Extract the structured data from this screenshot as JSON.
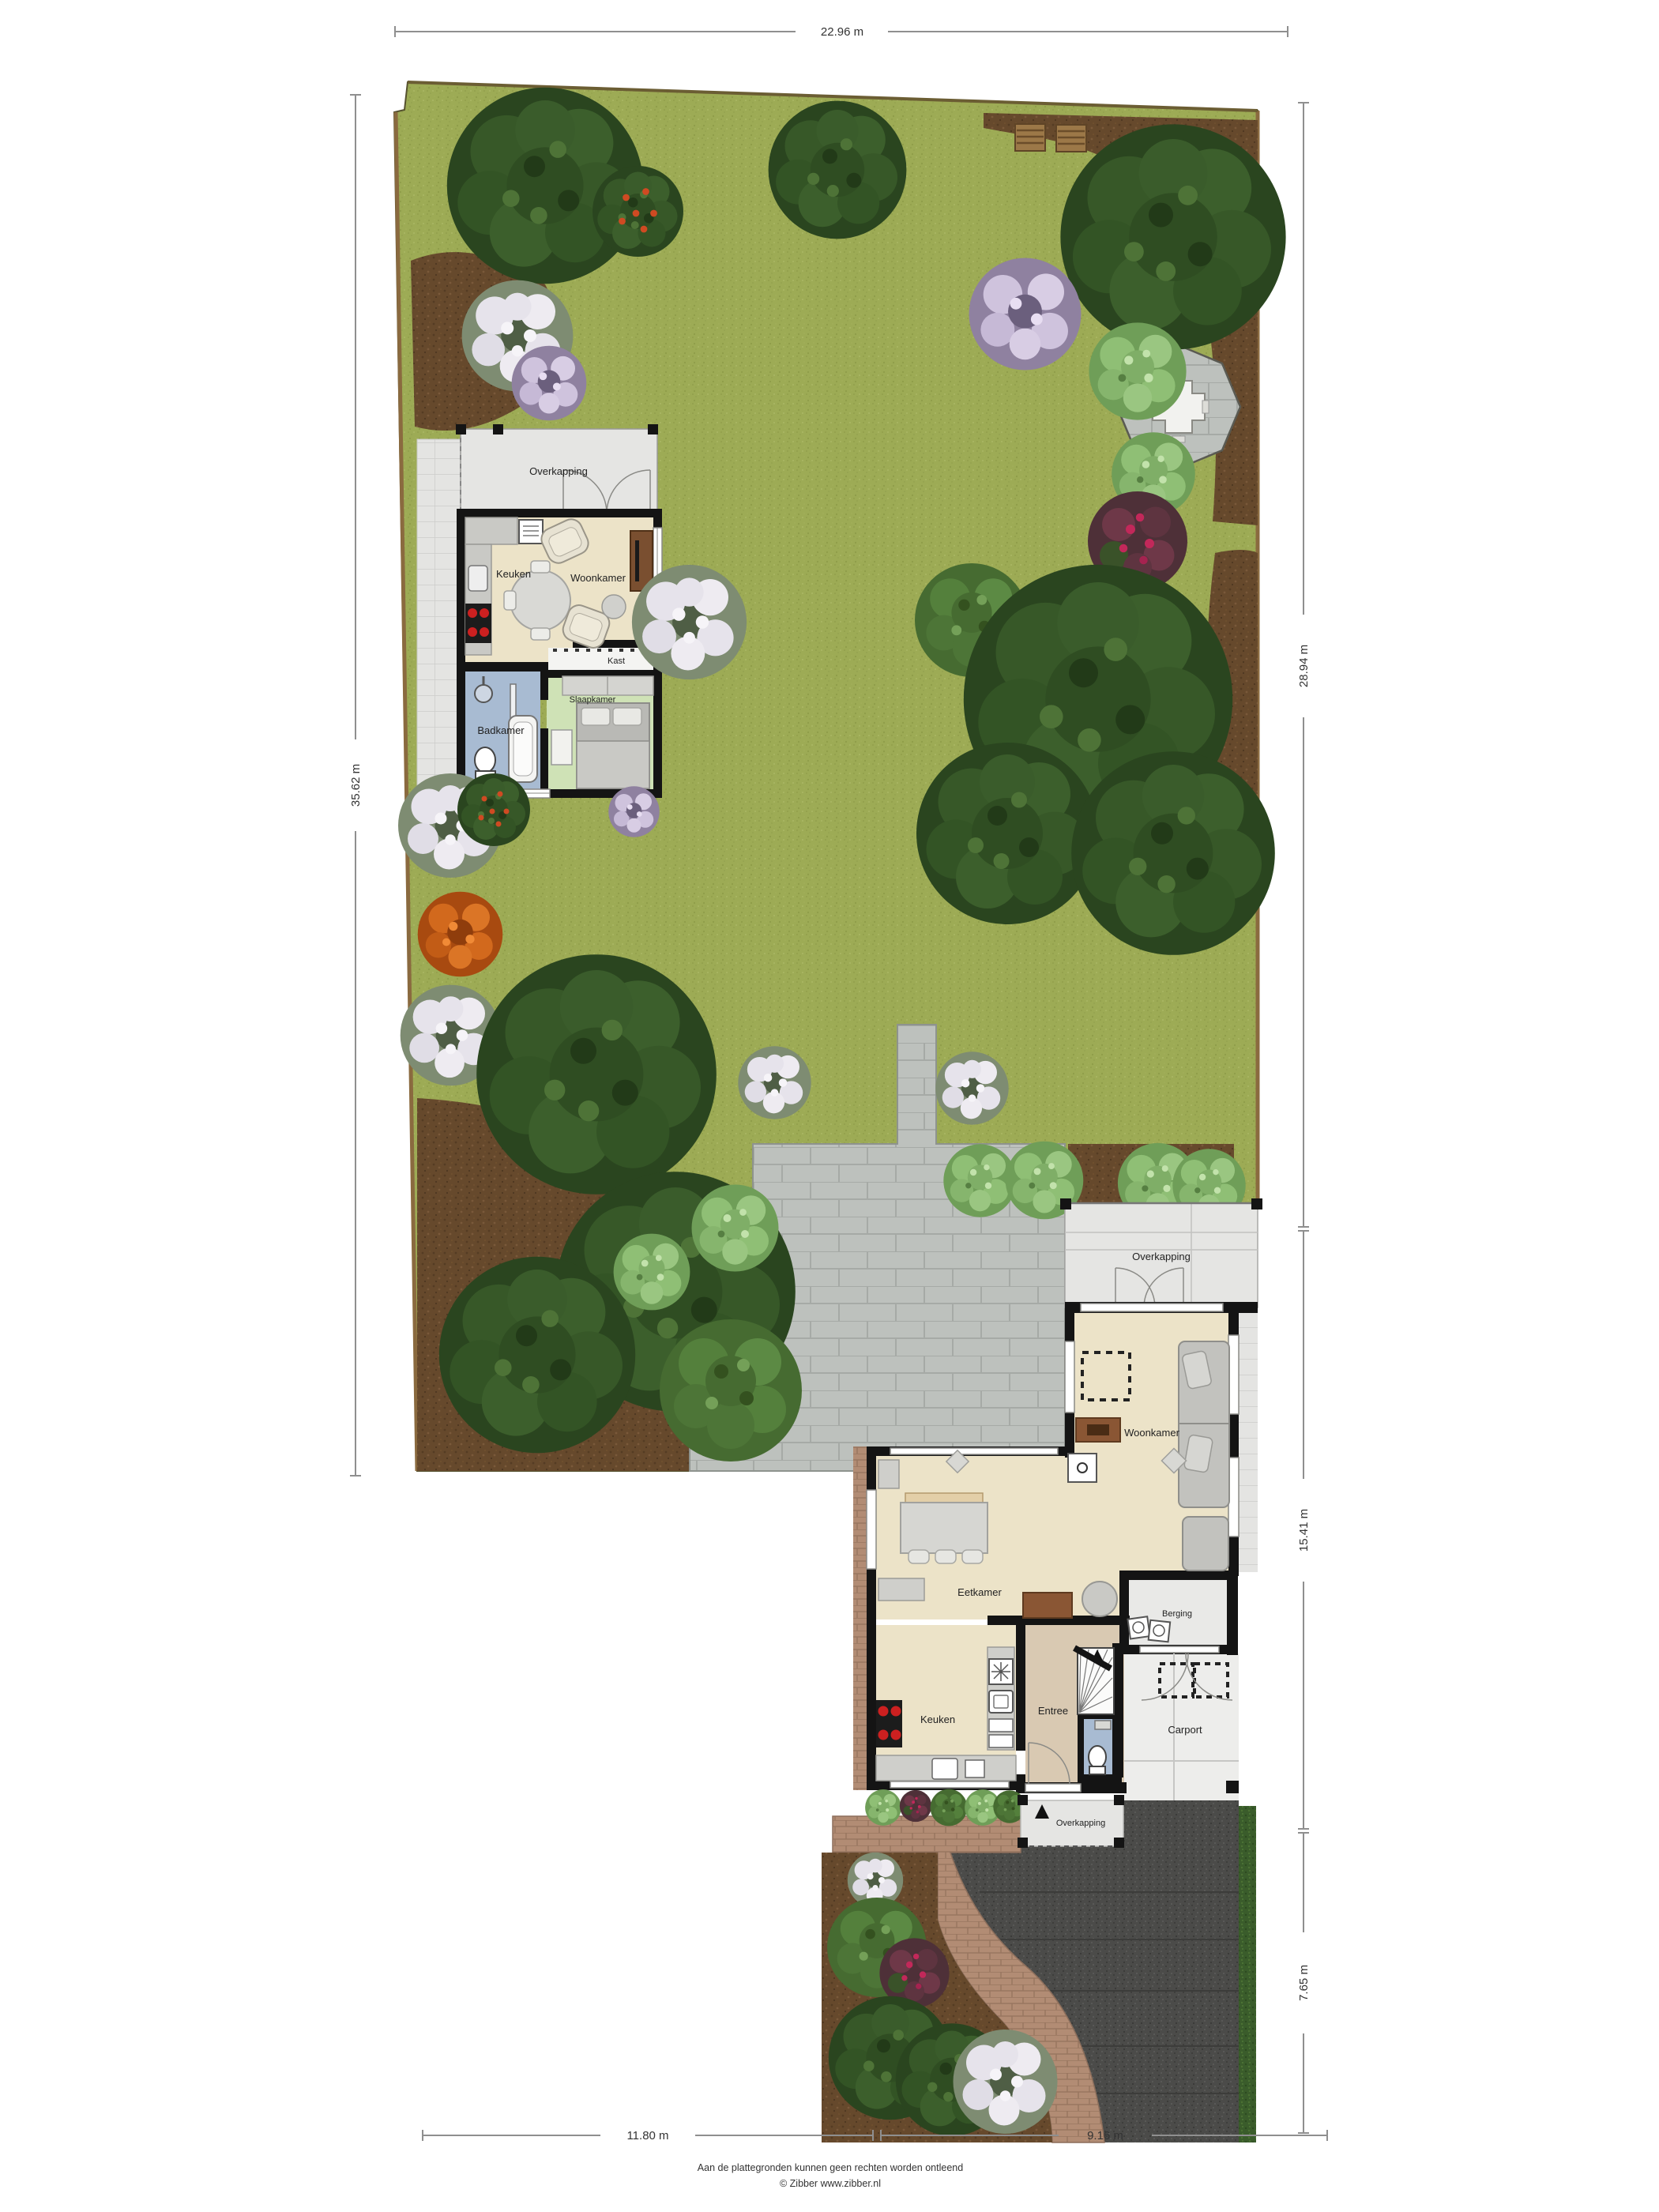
{
  "dimensions": {
    "top": "22.96 m",
    "left": "35.62 m",
    "right_upper": "28.94 m",
    "right_middle": "15.41 m",
    "right_lower": "7.65 m",
    "bottom_left": "11.80 m",
    "bottom_right": "9.16 m"
  },
  "annex": {
    "overkapping": "Overkapping",
    "keuken": "Keuken",
    "woonkamer": "Woonkamer",
    "kast": "Kast",
    "badkamer": "Badkamer",
    "slaapkamer": "Slaapkamer"
  },
  "house": {
    "overkapping": "Overkapping",
    "woonkamer": "Woonkamer",
    "eetkamer": "Eetkamer",
    "keuken": "Keuken",
    "entree": "Entree",
    "berging": "Berging",
    "carport": "Carport",
    "overkapping_front": "Overkapping"
  },
  "footer": {
    "line1": "Aan de plattegronden kunnen geen rechten worden ontleend",
    "line2": "© Zibber www.zibber.nl"
  },
  "colors": {
    "lawn": "#9dab55",
    "soil": "#66492c",
    "tree_dark": "#2e4a22",
    "bush_light": "#8fbf75",
    "paving": "#bdc1bd",
    "asphalt": "#4b4b49",
    "brick_path": "#b28c74",
    "hedge": "#3a5c2b",
    "wall": "#141414",
    "floor_living": "#ece3c8",
    "floor_bathroom": "#a8bbd2",
    "floor_bedroom": "#cfe2b6",
    "floor_entree": "#d9c9b2",
    "canopy": "#e5e5e3",
    "floor_utility": "#e9e9e7",
    "dimension_line": "#8f8f8f"
  }
}
